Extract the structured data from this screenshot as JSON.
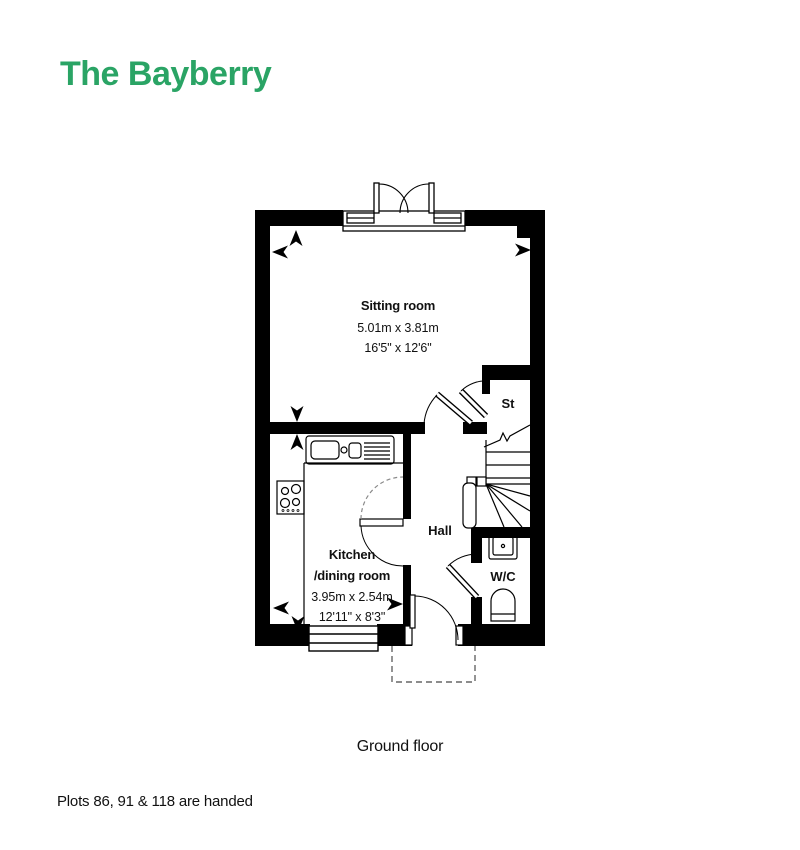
{
  "page": {
    "title": "The Bayberry",
    "caption": "Ground floor",
    "footnote": "Plots 86, 91 & 118 are handed"
  },
  "colors": {
    "brand_green": "#2aa465",
    "wall_black": "#000000",
    "text_dark": "#111111",
    "dashed_gray": "#666666"
  },
  "floorplan": {
    "sitting_room": {
      "name": "Sitting room",
      "metric": "5.01m x 3.81m",
      "imperial": "16'5\" x 12'6\""
    },
    "kitchen": {
      "name_line1": "Kitchen",
      "name_line2": "/dining room",
      "metric": "3.95m x 2.54m",
      "imperial": "12'11\" x 8'3\""
    },
    "hall": {
      "name": "Hall"
    },
    "st": {
      "name": "St"
    },
    "wc": {
      "name": "W/C"
    },
    "symbols": [
      "french-doors",
      "window",
      "front-door",
      "porch-outline",
      "staircase",
      "kitchen-sink",
      "hob",
      "wc-sink",
      "toilet",
      "door-swing-arcs",
      "dimension-arrows"
    ]
  }
}
